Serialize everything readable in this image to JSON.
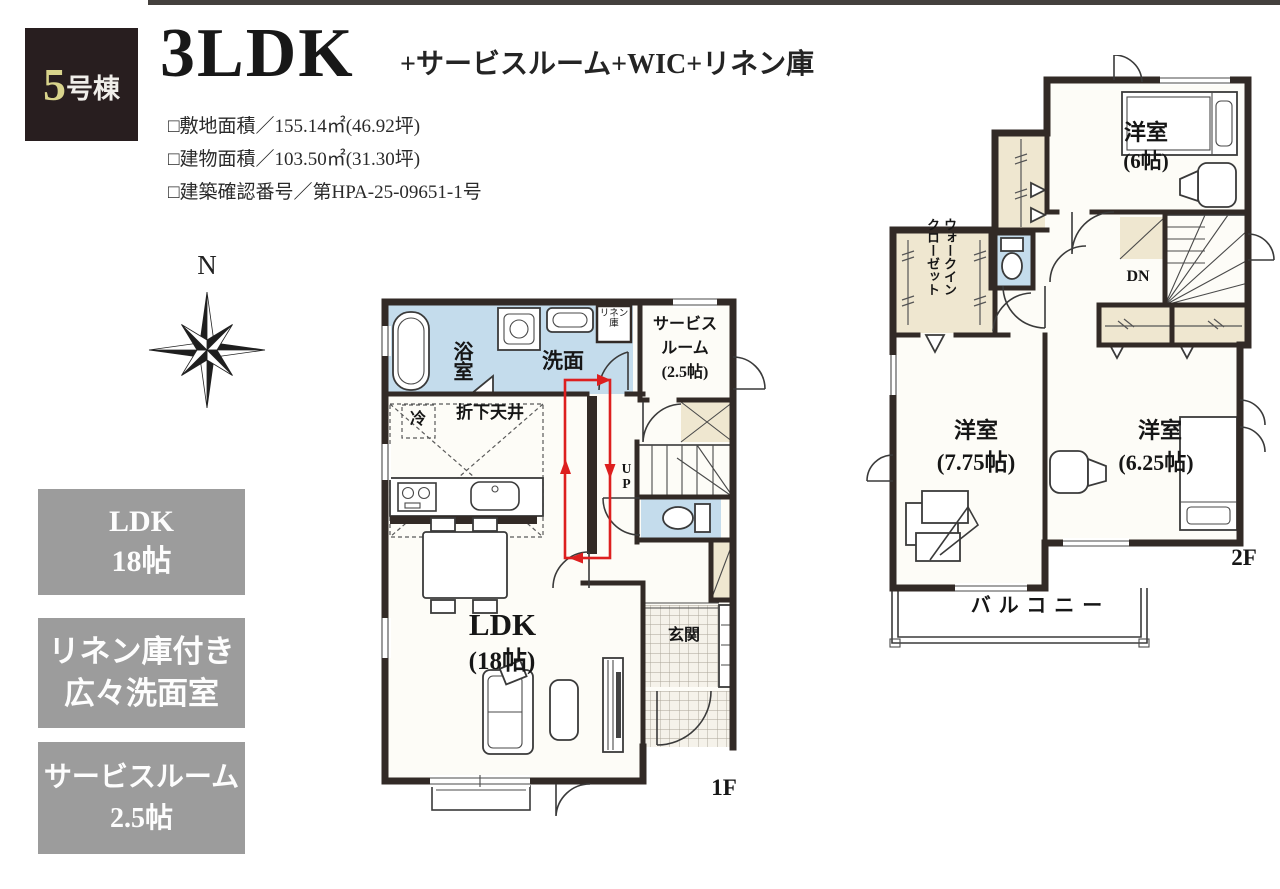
{
  "header": {
    "badge_number": "5",
    "badge_suffix": "号棟",
    "title": "3LDK",
    "subtitle": "+サービスルーム+WIC+リネン庫",
    "specs": [
      "□敷地面積／155.14㎡(46.92坪)",
      "□建物面積／103.50㎡(31.30坪)",
      "□建築確認番号／第HPA-25-09651-1号"
    ]
  },
  "compass": {
    "north_label": "N"
  },
  "features": [
    {
      "line1": "LDK",
      "line2": "18帖"
    },
    {
      "line1": "リネン庫付き",
      "line2": "広々洗面室"
    },
    {
      "line1": "サービスルーム",
      "line2": "2.5帖"
    }
  ],
  "floor1": {
    "floor_label": "1F",
    "bath": "浴室",
    "washroom": "洗面",
    "linen_line1": "リネン",
    "linen_line2": "庫",
    "service_line1": "サービス",
    "service_line2": "ルーム",
    "service_line3": "(2.5帖)",
    "dropped_ceiling": "折下天井",
    "fridge": "冷",
    "stairs_up": "UP",
    "ldk": "LDK",
    "ldk_size": "(18帖)",
    "entrance": "玄関"
  },
  "floor2": {
    "floor_label": "2F",
    "bedroom_a": "洋室",
    "bedroom_a_size": "(6帖)",
    "wic": "ウォークインクローゼット",
    "stairs_down": "DN",
    "bedroom_b": "洋室",
    "bedroom_b_size": "(7.75帖)",
    "bedroom_c": "洋室",
    "bedroom_c_size": "(6.25帖)",
    "balcony": "バルコニー"
  },
  "plan_colors": {
    "wall": "#322a26",
    "wet_area": "#c4dcec",
    "closet": "#efe7d0",
    "room": "#fdfcf7",
    "tile": "#f5f2ea",
    "highlight": "#dd1f1f",
    "feature_box_bg": "#9c9c9c"
  }
}
